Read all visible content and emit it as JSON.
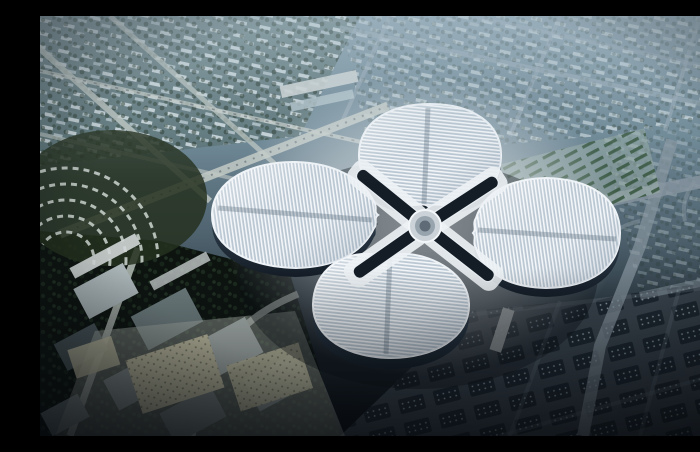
{
  "scene": {
    "description": "Aerial architectural rendering of a four-petal clover-shaped exhibition complex with striped white roofs around a central hub, surrounded by city blocks, diagonal roads and greenery; hazy blue toward the horizon and dark in the foreground"
  },
  "colors": {
    "haze_top": "#8ba2af",
    "haze_mid": "#6d8795",
    "mid_teal": "#4f636f",
    "deep_slate": "#232e37",
    "bottom_dark": "#0a0f14",
    "city_bar_light": "#d7e2e6",
    "city_bar_dim": "#b7c7cd",
    "district_tint": "#41594b",
    "tree_a": "#223425",
    "tree_b": "#1b2b1e",
    "tree_c": "#2a3d2b",
    "road_light": "#c3cac4",
    "road_blue": "#9fb0bc",
    "road_gray": "#8795a0",
    "road_dark": "#6a7680",
    "arc_row": "#cfd6d2",
    "curved_district": "#24301f",
    "petal_base": "#bac7d2",
    "petal_stripe": "#f4f7fa",
    "petal_edge": "#eef3f7",
    "seam": "#46596b",
    "facade_top": "#45586a",
    "facade_bottom": "#141d27",
    "building_shadow": "#0a0f16",
    "plaza_light": "#e8edf0",
    "white_x": "#edf2f5",
    "arm_dark": "#141d26",
    "hub_outer": "#cbd3d8",
    "hub_mid": "#97a3ad",
    "hub_core": "#5f6c77",
    "parking_base": "#9fb3a8",
    "parking_row": "#2f4f36",
    "br_ground": "#39434c",
    "br_block": "#1c262e",
    "br_dot": "#8fa0ab",
    "bl_ground": "#0d1410",
    "box_light": "#a9b4b7",
    "box_mid": "#6e7d7f",
    "box_dark": "#4d5a5e",
    "slab_white": "#cfd6d6",
    "tan_block": "#c8c5a9",
    "tan_dot": "#73745f",
    "tan_plaza": "#aeb3ab",
    "vignette": "#05080c",
    "haze_overlay": "#aabeca"
  }
}
